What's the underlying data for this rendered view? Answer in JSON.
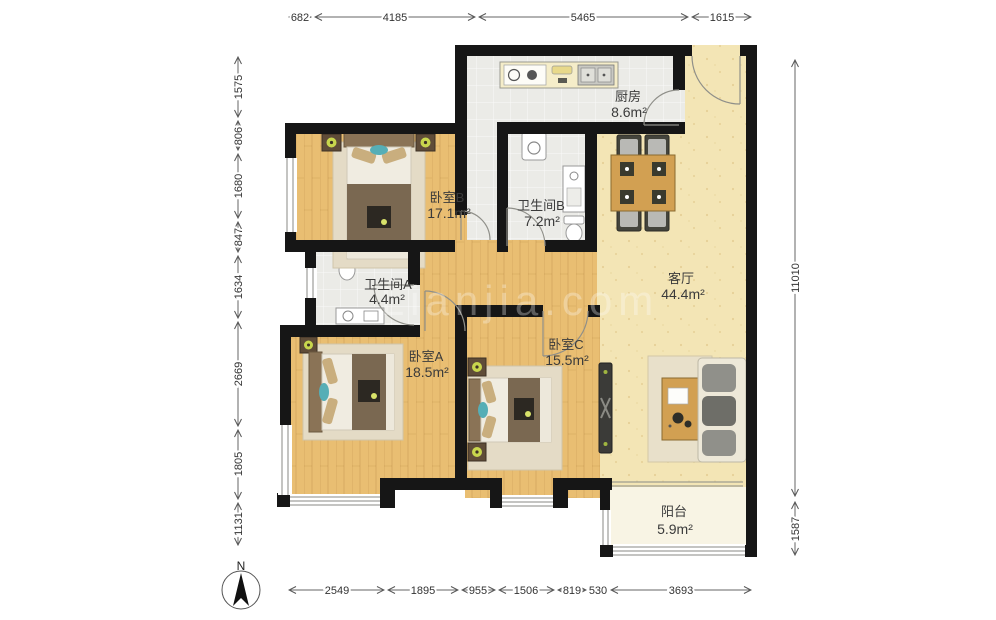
{
  "plan": {
    "watermark": "Lianjia.com",
    "north_label": "N",
    "rooms": {
      "kitchen": {
        "name": "厨房",
        "area": "8.6m²"
      },
      "bedroom_b": {
        "name": "卧室B",
        "area": "17.1m²"
      },
      "bathroom_b": {
        "name": "卫生间B",
        "area": "7.2m²"
      },
      "living_room": {
        "name": "客厅",
        "area": "44.4m²"
      },
      "bathroom_a": {
        "name": "卫生间A",
        "area": "4.4m²"
      },
      "bedroom_a": {
        "name": "卧室A",
        "area": "18.5m²"
      },
      "bedroom_c": {
        "name": "卧室C",
        "area": "15.5m²"
      },
      "balcony": {
        "name": "阳台",
        "area": "5.9m²"
      }
    },
    "dimensions": {
      "top": [
        "682",
        "4185",
        "5465",
        "1615"
      ],
      "bottom": [
        "2549",
        "1895",
        "955",
        "1506",
        "819",
        "530",
        "3693"
      ],
      "left": [
        "1575",
        "806",
        "1680",
        "847",
        "1634",
        "2669",
        "1805",
        "1131"
      ],
      "right": [
        "11010",
        "1587"
      ]
    },
    "colors": {
      "wood": "#E9BE72",
      "living": "#F3E5B5",
      "tile": "#EBEBE7",
      "balcony": "#F8F4E4",
      "wall": "#161616"
    }
  }
}
